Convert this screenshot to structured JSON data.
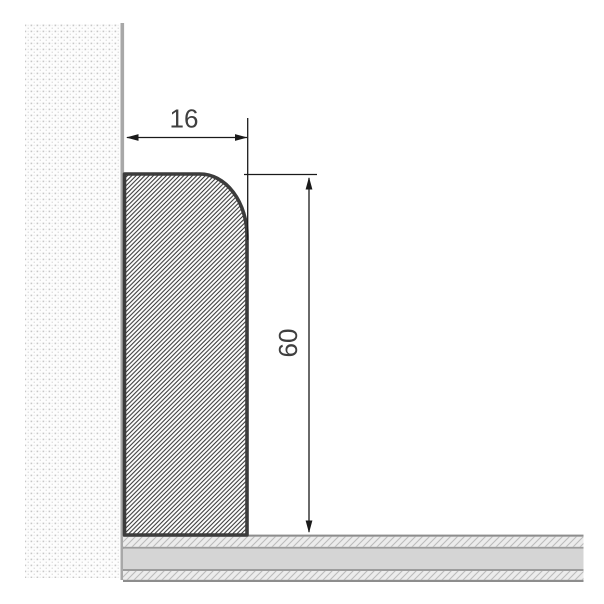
{
  "diagram": {
    "width_dimension": "16",
    "height_dimension": "60"
  },
  "colors": {
    "background": "#ffffff",
    "board_outline": "#3c3c3c",
    "board_hatch_line": "#2d2d2d",
    "wall_dot_dark": "#c7c7c7",
    "wall_dot_light": "#e0e0e0",
    "wall_edge": "#a8a8a8",
    "floor_border": "#8d8d8d",
    "floor_divider": "#9c9c9c",
    "floor_plain": "#d5d5d5",
    "floor_hatch_bg": "#ececec",
    "floor_hatch_line": "#bcbcbc",
    "dimension_line": "#1a1a1a",
    "label_text": "#3f3f3f"
  }
}
